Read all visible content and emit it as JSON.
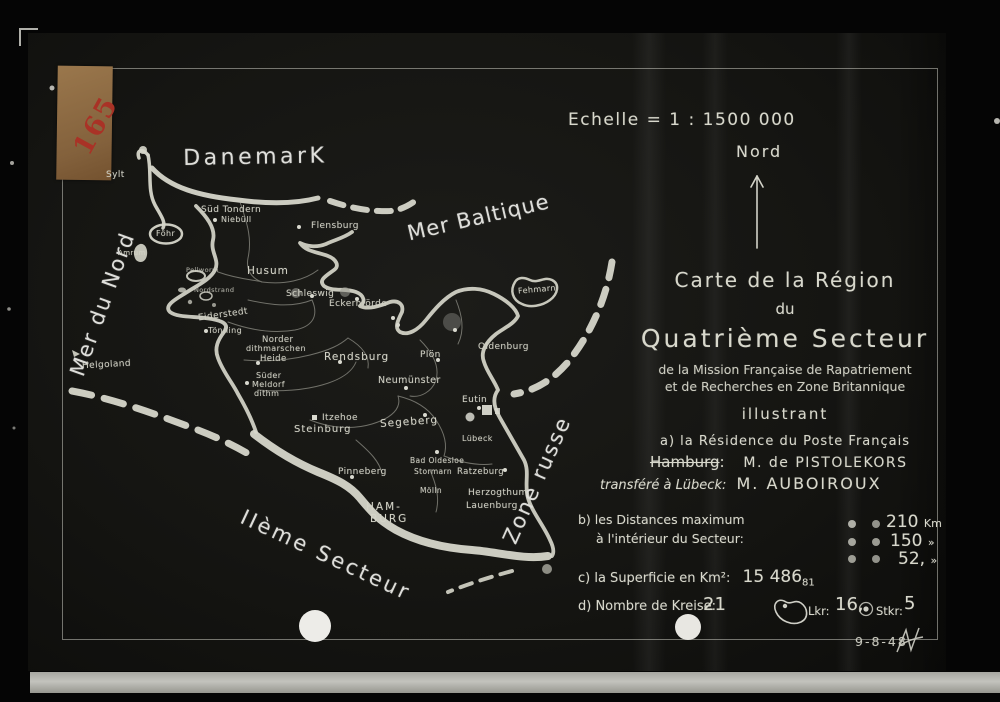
{
  "frame": {
    "label_number": "165",
    "date": "9-8-48"
  },
  "compass": {
    "scale": "Echelle = 1 : 1500 000",
    "north": "Nord"
  },
  "title_block": {
    "line1": "Carte de la Région",
    "line2": "du",
    "line3": "Quatrième Secteur",
    "line4": "de la Mission Française de Rapatriement",
    "line5": "et de Recherches en Zone Britannique",
    "line6": "illustrant",
    "item_a": "a) la Résidence du Poste Français"
  },
  "residence": {
    "crossed_city": "Hamburg",
    "colon": ":",
    "chief1": "M. de PISTOLEKORS",
    "transfer_prefix": "transféré à Lübeck:",
    "chief2": "M. AUBOIROUX"
  },
  "distances": {
    "label_line1": "b) les Distances maximum",
    "label_line2": "à l'intérieur du Secteur:",
    "rows": [
      {
        "value": "210",
        "unit": "Km"
      },
      {
        "value": "150",
        "unit": "»"
      },
      {
        "value": "52,",
        "unit": "»"
      }
    ]
  },
  "surface": {
    "label": "c) la Superficie en Km²:",
    "value": "15 486",
    "decimals": "81"
  },
  "kreise": {
    "label": "d) Nombre de Kreise:",
    "total": "21",
    "lkr_label": "Lkr:",
    "lkr_value": "16,",
    "stkr_label": "Stkr:",
    "stkr_value": "5"
  },
  "map": {
    "seas": {
      "danemark": "DanemarK",
      "mer_du_nord": "Mer du Nord",
      "mer_baltique": "Mer Baltique",
      "zone_russe": "Zone russe",
      "second_sector": "IIème Secteur"
    },
    "islands": {
      "sylt": "Sylt",
      "foehr": "Föhr",
      "amrum": "Amrum",
      "helgoland": "Helgoland",
      "fehmarn": "Fehmarn",
      "pellworm": "Pellworm",
      "nordstrand": "Nordstrand"
    },
    "places": {
      "sued_tondern": "Süd Tondern",
      "niebuell": "Niebüll",
      "flensburg": "Flensburg",
      "husum": "Husum",
      "schleswig": "Schleswig",
      "eckernfoerde": "Eckernförde",
      "eiderstedt": "Eiderstedt",
      "toenning": "Tönning",
      "norder1": "Norder",
      "norder2": "dithmarschen",
      "heide": "Heide",
      "sueder1": "Süder",
      "sueder2": "Meldorf",
      "sueder3": "dithm",
      "rendsburg": "Rendsburg",
      "neumuenster": "Neumünster",
      "ploen": "Plön",
      "oldenburg": "Oldenburg",
      "eutin": "Eutin",
      "luebeck": "Lübeck",
      "itzehoe": "Itzehoe",
      "steinburg": "Steinburg",
      "segeberg": "Segeberg",
      "pinneberg": "Pinneberg",
      "bad_oldesloe": "Bad Oldesloe",
      "stormarn": "Stormarn",
      "moelln": "Mölln",
      "ratzeburg": "Ratzeburg",
      "herzogthum": "Herzogthum",
      "lauenburg": "Lauenburg",
      "hamburg1": "HAM-",
      "hamburg2": "BURG"
    }
  },
  "colors": {
    "ink": "#d8d8cc",
    "card": "#151512",
    "label_tan": "#8f6f46",
    "label_red": "#a93226"
  }
}
